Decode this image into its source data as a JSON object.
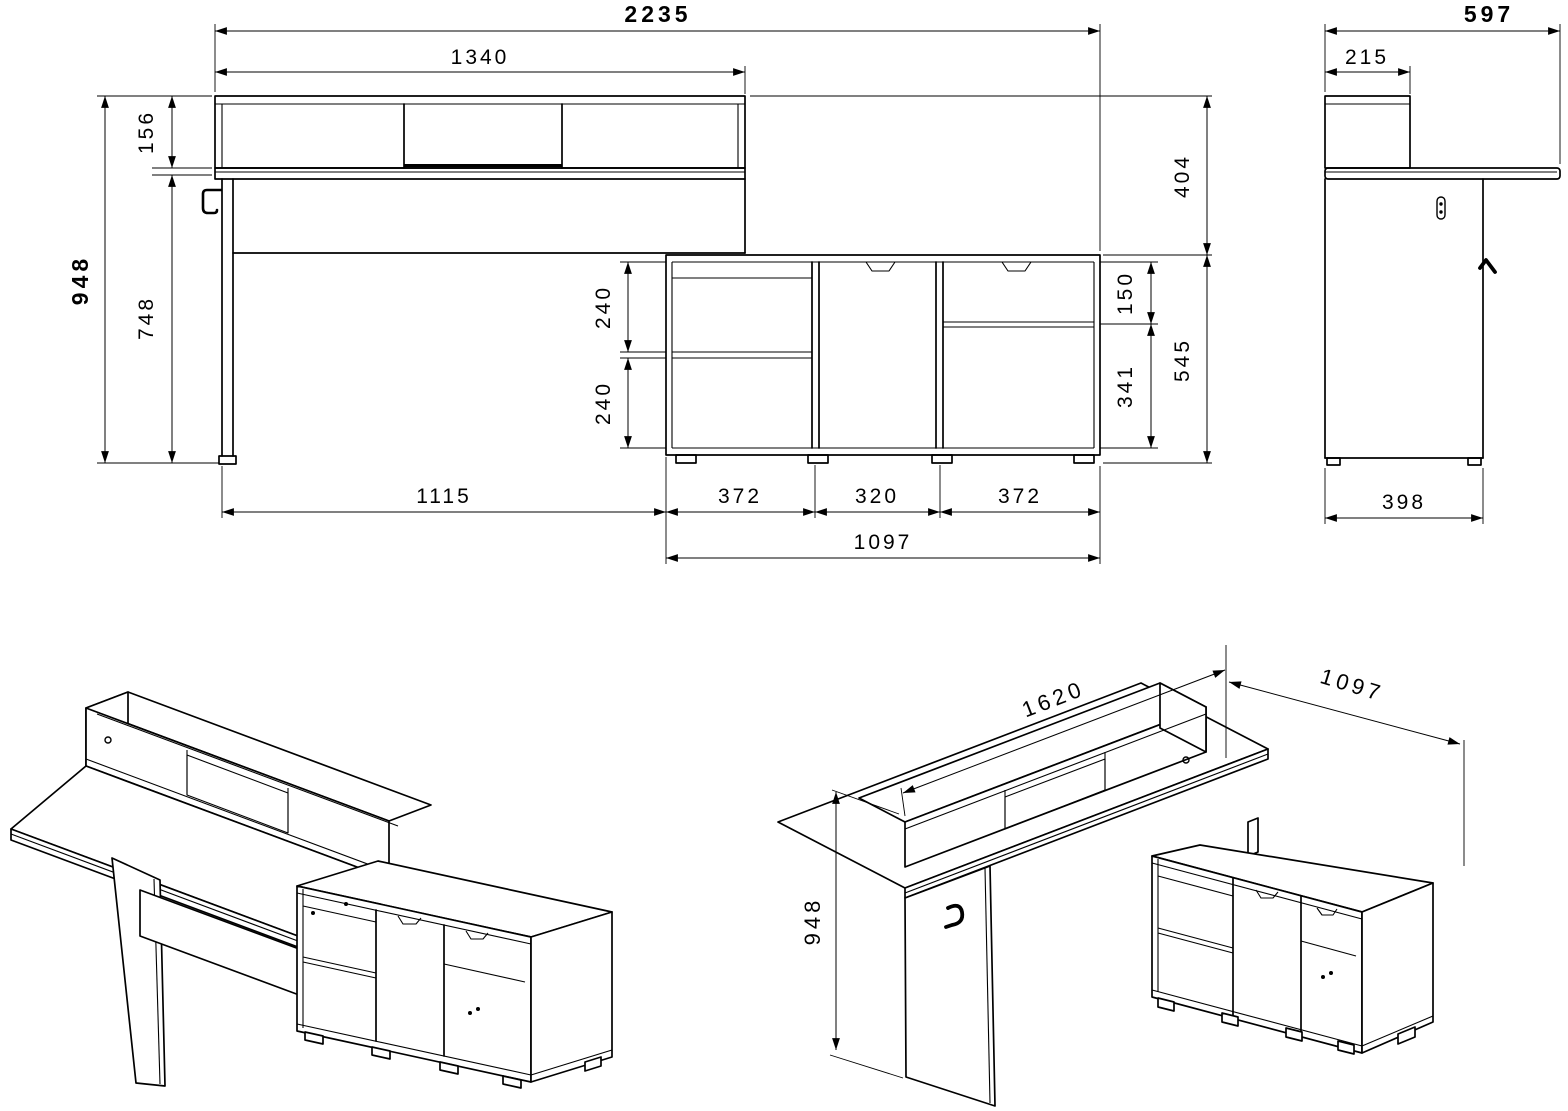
{
  "title": "Desk with hutch and sideboard - dimensioned technical drawing",
  "colors": {
    "background": "#ffffff",
    "line": "#000000"
  },
  "views": {
    "front": {
      "label": "front-elevation",
      "dims": {
        "total_width": "2235",
        "desk_width": "1340",
        "hutch_height": "156",
        "total_height": "948",
        "desk_height": "748",
        "hutch_to_cabinet_gap": "404",
        "cabinet_height": "545",
        "drawer_height": "150",
        "door_height": "341",
        "shelf_upper": "240",
        "shelf_lower": "240",
        "leg_to_cabinet": "1115",
        "cabinet_left": "372",
        "cabinet_middle": "320",
        "cabinet_right": "372",
        "cabinet_width": "1097"
      }
    },
    "side": {
      "label": "side-elevation",
      "dims": {
        "total_depth": "597",
        "hutch_depth": "215",
        "panel_depth": "398"
      }
    },
    "iso_left": {
      "label": "isometric-front-left"
    },
    "iso_right": {
      "label": "isometric-front-right",
      "dims": {
        "desk_width": "1620",
        "return_width": "1097",
        "total_height": "948"
      }
    }
  }
}
